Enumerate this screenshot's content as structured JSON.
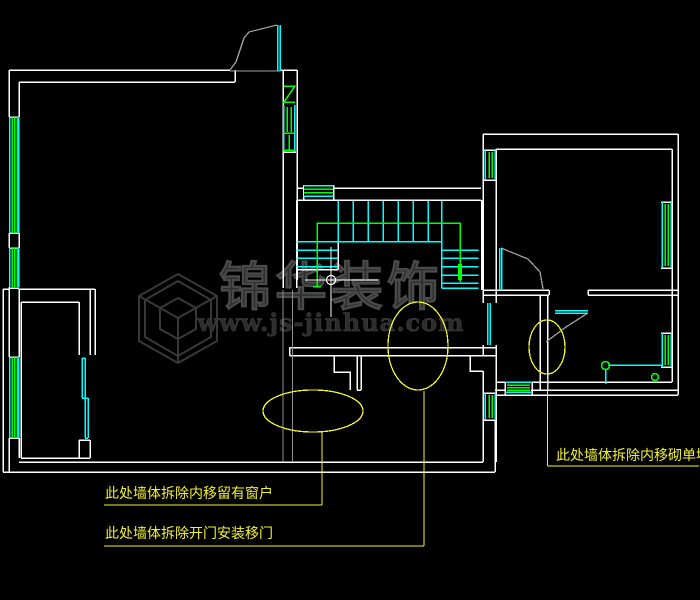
{
  "drawing": {
    "type": "cad-floor-plan-demolition",
    "annotations": [
      {
        "id": "note-keep-window",
        "text": "此处墙体拆除内移留有窗户"
      },
      {
        "id": "note-sliding-door",
        "text": "此处墙体拆除开门安装移门"
      },
      {
        "id": "note-single-wall",
        "text": "此处墙体拆除内移砌单墙"
      }
    ],
    "watermark": {
      "brand": "锦华装饰",
      "url": "www.js-jinhua.com"
    },
    "colors": {
      "background": "#000000",
      "wall": "#ffffff",
      "window": "#00ffff",
      "detail_green": "#00ff00",
      "annotation": "#f2f22b",
      "door_swing": "#a0a0a0",
      "demolition": "#8f8f8f"
    }
  }
}
